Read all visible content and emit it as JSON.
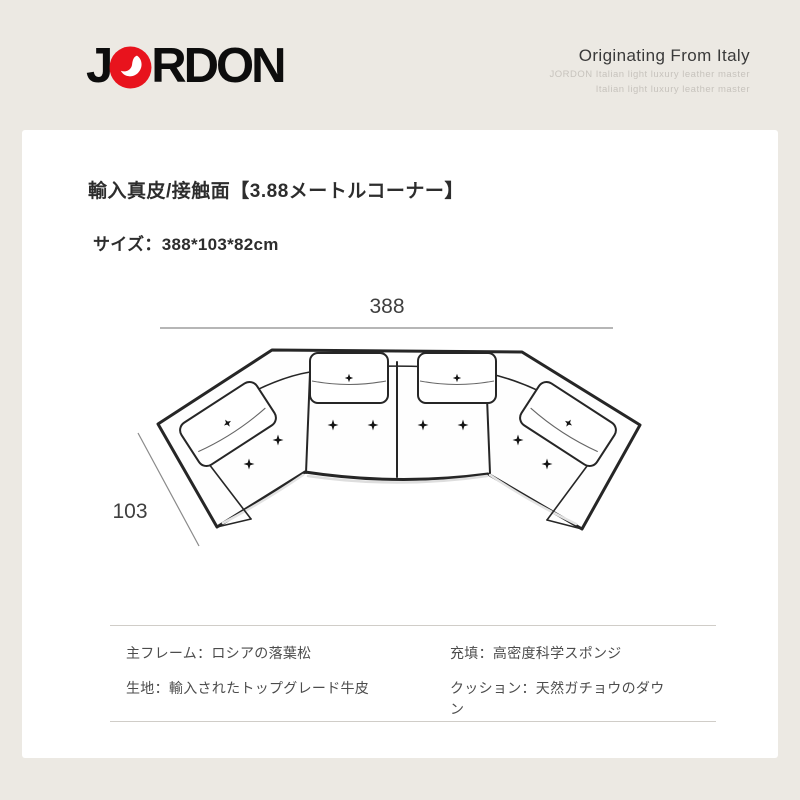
{
  "colors": {
    "background": "#ece9e3",
    "card": "#ffffff",
    "brand_red": "#e8131d",
    "text_dark": "#2d2d2d",
    "text_gray": "#4c4c4c",
    "subline_gray": "#c7c3bd",
    "divider": "#d0cdc8",
    "sofa_stroke": "#262626"
  },
  "header": {
    "logo": {
      "j": "J",
      "o": "O",
      "rest": "RDON"
    },
    "tagline": "Originating From Italy",
    "subline1": "JORDON Italian light luxury leather master",
    "subline2": "Italian light luxury leather master"
  },
  "product": {
    "title": "輸入真皮/接触面【3.88メートルコーナー】",
    "size_label": "サイズ：388*103*82cm"
  },
  "diagram": {
    "type": "top-view corner sofa line drawing",
    "width_label": "388",
    "depth_label": "103",
    "seats": 4
  },
  "specs": {
    "left": [
      "主フレーム：ロシアの落葉松",
      "生地：輸入されたトップグレード牛皮"
    ],
    "right": [
      "充填：高密度科学スポンジ",
      "クッション：天然ガチョウのダウン"
    ]
  }
}
